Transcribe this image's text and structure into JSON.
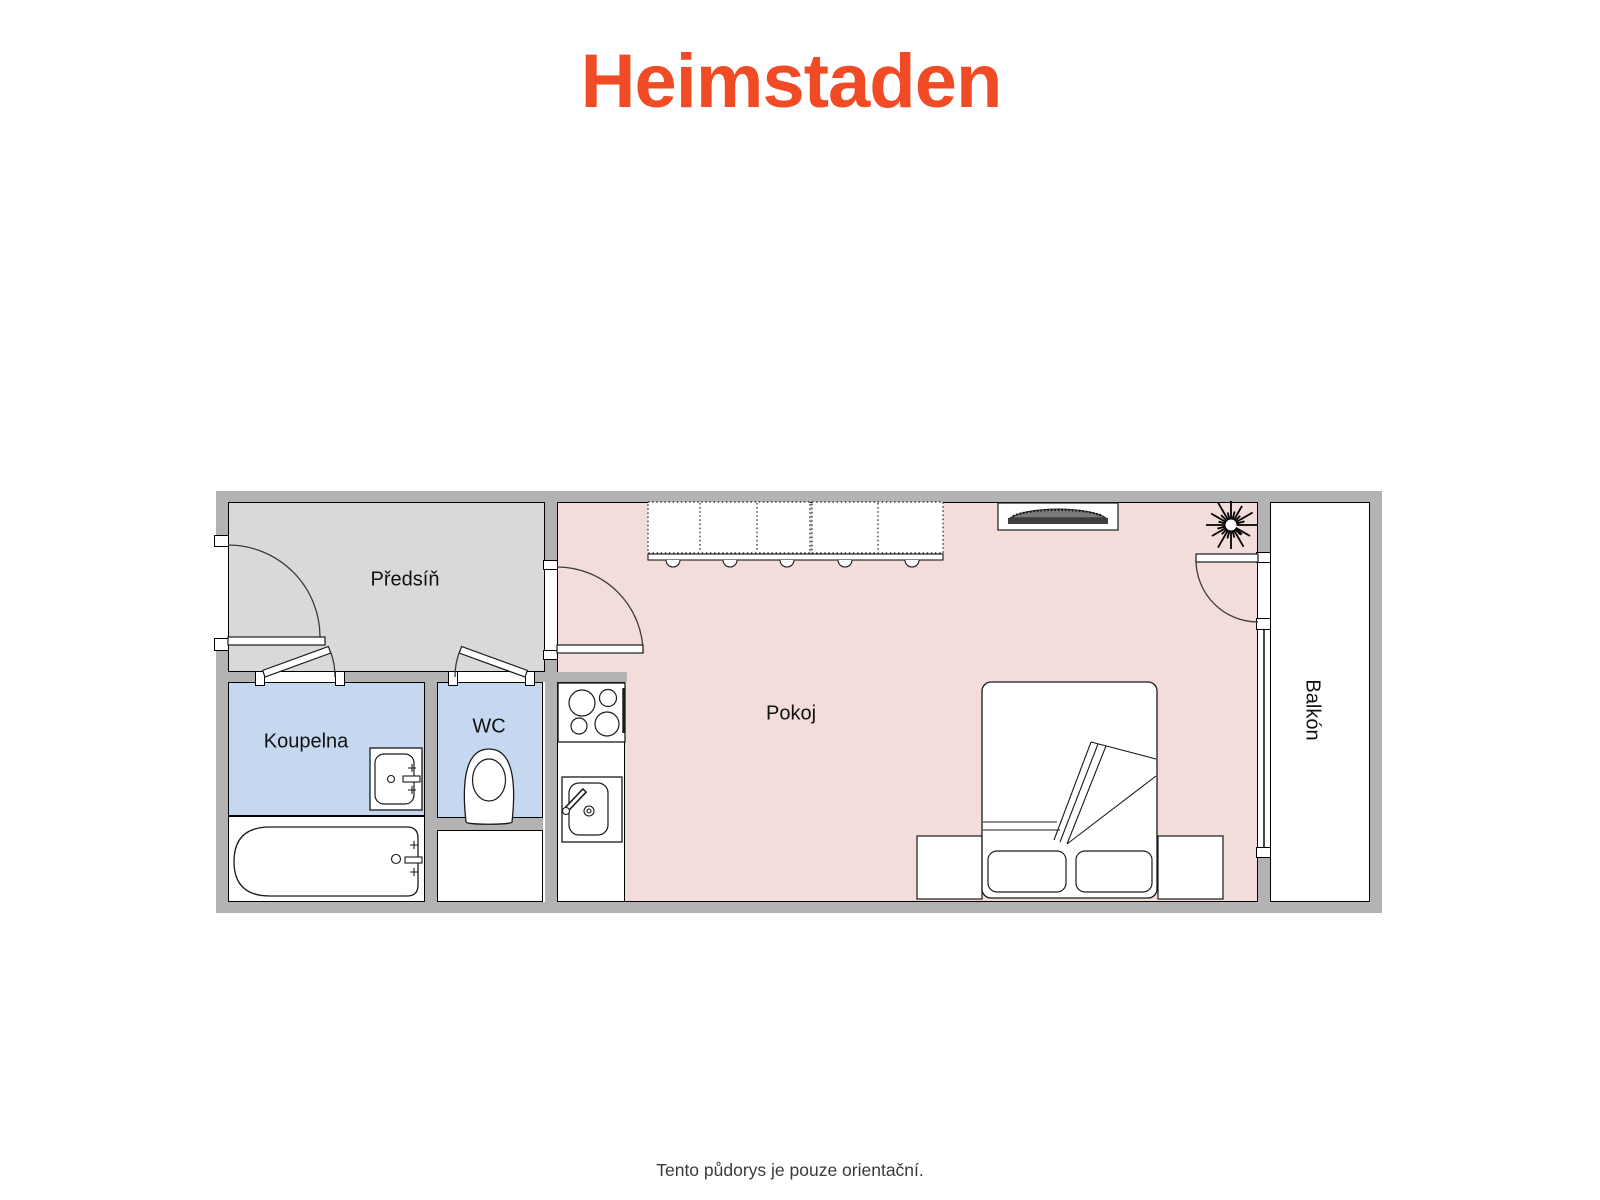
{
  "logo": {
    "text": "Heimstaden"
  },
  "caption": {
    "text": "Tento půdorys je pouze orientační."
  },
  "rooms": [
    {
      "id": "predsin",
      "label": "Předsíň"
    },
    {
      "id": "koupelna",
      "label": "Koupelna"
    },
    {
      "id": "wc",
      "label": "WC"
    },
    {
      "id": "pokoj",
      "label": "Pokoj"
    },
    {
      "id": "balkon",
      "label": "Balkón"
    }
  ],
  "palette": {
    "brand_orange": "#F04B25",
    "wall_gray": "#B3B3B3",
    "hall_floor_gray": "#D9D9D9",
    "bathroom_floor_blue": "#C6D8F0",
    "living_floor_pink": "#F3DDDB",
    "balcony_floor_white": "#FFFFFF",
    "caption_color": "#3A3A3A"
  },
  "icons": {
    "wardrobe": "wardrobe-icon",
    "tv": "tv-icon",
    "plant": "plant-icon",
    "bed": "double-bed-icon",
    "pillows": "pillow-icon",
    "nightstands": "nightstand-icon",
    "stove": "stove-icon",
    "kitchen_sink": "kitchen-sink-icon",
    "washbasin": "washbasin-icon",
    "bathtub": "bathtub-icon",
    "toilet": "toilet-icon",
    "doors": "door-swing-icon",
    "window": "window-icon"
  }
}
